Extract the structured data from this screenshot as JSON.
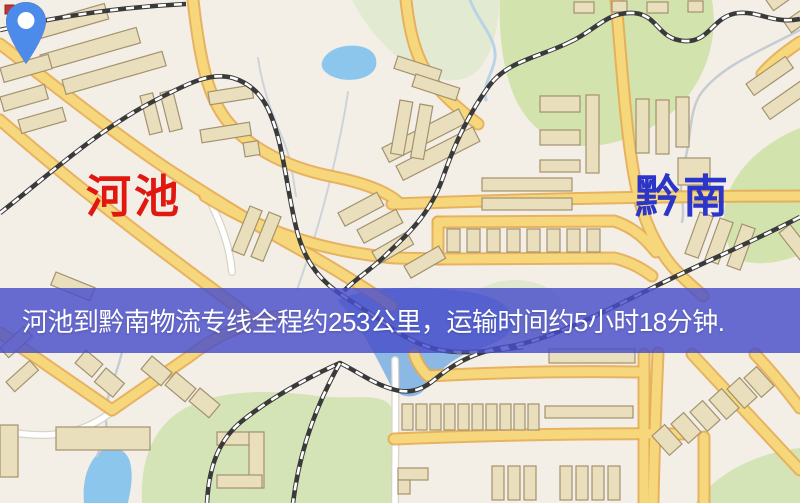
{
  "map": {
    "origin": {
      "label": "河池",
      "pin_color": "#e2251a",
      "label_color": "#e0180f"
    },
    "destination": {
      "label": "黔南",
      "pin_color": "#4c8bea",
      "label_color": "#2b35c8"
    },
    "banner": {
      "text": "河池到黔南物流专线全程约253公里，运输时间约5小时18分钟.",
      "background": "#4a4eca",
      "text_color": "#ffffff"
    },
    "legend_colors": {
      "map_background": "#f3efe6",
      "road_major": "#f7d77b",
      "park_green": "#d3e3ae",
      "water_blue": "#8cc6ec",
      "railway": "#3a3a3a"
    }
  }
}
